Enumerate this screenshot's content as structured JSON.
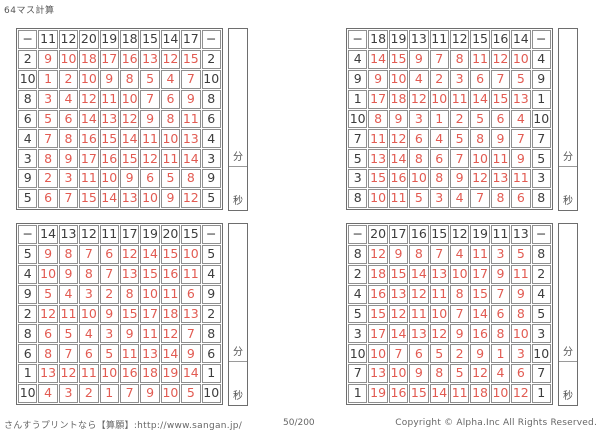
{
  "title": "64マス計算",
  "timer": {
    "minutes_label": "分",
    "seconds_label": "秒"
  },
  "colors": {
    "answer": "#e25b52",
    "header": "#3d3d3d",
    "grid_line": "#8f8f8f"
  },
  "footer": {
    "site": "さんすうプリントなら【算願】:http://www.sangan.jp/",
    "page_number": "50/200",
    "copyright": "Copyright © Alpha.Inc All Rights Reserved."
  },
  "grids": [
    {
      "position": "top-left",
      "operator": "−",
      "col_headers": [
        11,
        12,
        20,
        19,
        18,
        15,
        14,
        17
      ],
      "rows": [
        {
          "left": 2,
          "answers": [
            9,
            10,
            18,
            17,
            16,
            13,
            12,
            15
          ]
        },
        {
          "left": 10,
          "answers": [
            1,
            2,
            10,
            9,
            8,
            5,
            4,
            7
          ]
        },
        {
          "left": 8,
          "answers": [
            3,
            4,
            12,
            11,
            10,
            7,
            6,
            9
          ]
        },
        {
          "left": 6,
          "answers": [
            5,
            6,
            14,
            13,
            12,
            9,
            8,
            11
          ]
        },
        {
          "left": 4,
          "answers": [
            7,
            8,
            16,
            15,
            14,
            11,
            10,
            13
          ]
        },
        {
          "left": 3,
          "answers": [
            8,
            9,
            17,
            16,
            15,
            12,
            11,
            14
          ]
        },
        {
          "left": 9,
          "answers": [
            2,
            3,
            11,
            10,
            9,
            6,
            5,
            8
          ]
        },
        {
          "left": 5,
          "answers": [
            6,
            7,
            15,
            14,
            13,
            10,
            9,
            12
          ]
        }
      ]
    },
    {
      "position": "top-right",
      "operator": "−",
      "col_headers": [
        18,
        19,
        13,
        11,
        12,
        15,
        16,
        14
      ],
      "rows": [
        {
          "left": 4,
          "answers": [
            14,
            15,
            9,
            7,
            8,
            11,
            12,
            10
          ]
        },
        {
          "left": 9,
          "answers": [
            9,
            10,
            4,
            2,
            3,
            6,
            7,
            5
          ]
        },
        {
          "left": 1,
          "answers": [
            17,
            18,
            12,
            10,
            11,
            14,
            15,
            13
          ]
        },
        {
          "left": 10,
          "answers": [
            8,
            9,
            3,
            1,
            2,
            5,
            6,
            4
          ]
        },
        {
          "left": 7,
          "answers": [
            11,
            12,
            6,
            4,
            5,
            8,
            9,
            7
          ]
        },
        {
          "left": 5,
          "answers": [
            13,
            14,
            8,
            6,
            7,
            10,
            11,
            9
          ]
        },
        {
          "left": 3,
          "answers": [
            15,
            16,
            10,
            8,
            9,
            12,
            13,
            11
          ]
        },
        {
          "left": 8,
          "answers": [
            10,
            11,
            5,
            3,
            4,
            7,
            8,
            6
          ]
        }
      ]
    },
    {
      "position": "bottom-left",
      "operator": "−",
      "col_headers": [
        14,
        13,
        12,
        11,
        17,
        19,
        20,
        15
      ],
      "rows": [
        {
          "left": 5,
          "answers": [
            9,
            8,
            7,
            6,
            12,
            14,
            15,
            10
          ]
        },
        {
          "left": 4,
          "answers": [
            10,
            9,
            8,
            7,
            13,
            15,
            16,
            11
          ]
        },
        {
          "left": 9,
          "answers": [
            5,
            4,
            3,
            2,
            8,
            10,
            11,
            6
          ]
        },
        {
          "left": 2,
          "answers": [
            12,
            11,
            10,
            9,
            15,
            17,
            18,
            13
          ]
        },
        {
          "left": 8,
          "answers": [
            6,
            5,
            4,
            3,
            9,
            11,
            12,
            7
          ]
        },
        {
          "left": 6,
          "answers": [
            8,
            7,
            6,
            5,
            11,
            13,
            14,
            9
          ]
        },
        {
          "left": 1,
          "answers": [
            13,
            12,
            11,
            10,
            16,
            18,
            19,
            14
          ]
        },
        {
          "left": 10,
          "answers": [
            4,
            3,
            2,
            1,
            7,
            9,
            10,
            5
          ]
        }
      ]
    },
    {
      "position": "bottom-right",
      "operator": "−",
      "col_headers": [
        20,
        17,
        16,
        15,
        12,
        19,
        11,
        13
      ],
      "rows": [
        {
          "left": 8,
          "answers": [
            12,
            9,
            8,
            7,
            4,
            11,
            3,
            5
          ]
        },
        {
          "left": 2,
          "answers": [
            18,
            15,
            14,
            13,
            10,
            17,
            9,
            11
          ]
        },
        {
          "left": 4,
          "answers": [
            16,
            13,
            12,
            11,
            8,
            15,
            7,
            9
          ]
        },
        {
          "left": 5,
          "answers": [
            15,
            12,
            11,
            10,
            7,
            14,
            6,
            8
          ]
        },
        {
          "left": 3,
          "answers": [
            17,
            14,
            13,
            12,
            9,
            16,
            8,
            10
          ]
        },
        {
          "left": 10,
          "answers": [
            10,
            7,
            6,
            5,
            2,
            9,
            1,
            3
          ]
        },
        {
          "left": 7,
          "answers": [
            13,
            10,
            9,
            8,
            5,
            12,
            4,
            6
          ]
        },
        {
          "left": 1,
          "answers": [
            19,
            16,
            15,
            14,
            11,
            18,
            10,
            12
          ]
        }
      ]
    }
  ]
}
